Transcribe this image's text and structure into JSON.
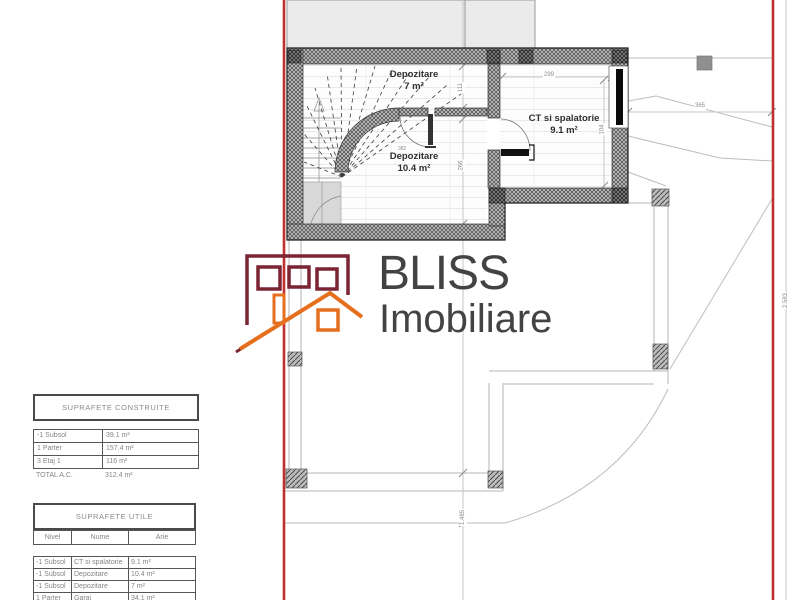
{
  "plan": {
    "rooms": [
      {
        "name": "Depozitare",
        "area": "7 m²"
      },
      {
        "name": "Depozitare",
        "area": "10.4 m²"
      },
      {
        "name": "CT si spalatorie",
        "area": "9.1 m²"
      }
    ],
    "dims": {
      "d299": "299",
      "d111": "111",
      "d382": "382",
      "d266": "266",
      "d104": "104",
      "d365": "365",
      "d2583": "2.583",
      "d1485": "1.485"
    },
    "colors": {
      "boundary_red": "#c03030",
      "wall_dark": "#3a3a3a",
      "thin_line": "#b5b5b5"
    }
  },
  "logo": {
    "title": "BLISS",
    "subtitle": "Imobiliare",
    "colors": {
      "maroon": "#7b2433",
      "orange": "#e66f1e",
      "text": "#434343"
    }
  },
  "tables": {
    "constructed": {
      "title": "SUPRAFETE CONSTRUITE",
      "rows": [
        [
          "-1 Subsol",
          "39.1 m²"
        ],
        [
          "1 Parter",
          "157.4 m²"
        ],
        [
          "3 Etaj 1",
          "116 m²"
        ]
      ],
      "total_label": "TOTAL A.C.",
      "total_value": "312.4 m²"
    },
    "usable": {
      "title": "SUPRAFETE UTILE",
      "columns": [
        "Nivel",
        "Nume",
        "Arie"
      ],
      "rows": [
        [
          "-1 Subsol",
          "CT si spalatorie",
          "9.1 m²"
        ],
        [
          "-1 Subsol",
          "Depozitare",
          "10.4 m²"
        ],
        [
          "-1 Subsol",
          "Depozitare",
          "7 m²"
        ],
        [
          "1 Parter",
          "Garaj",
          "34.1 m²"
        ]
      ]
    }
  }
}
